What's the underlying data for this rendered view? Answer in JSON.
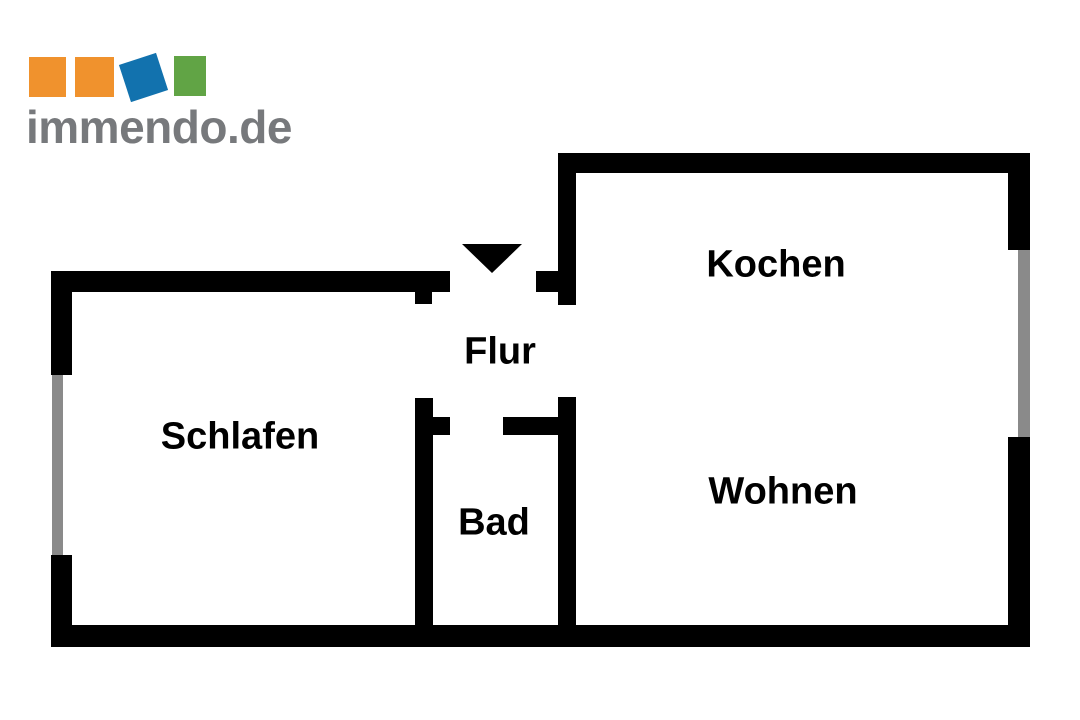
{
  "logo": {
    "text": "immendo.de",
    "squares": [
      "orange-square",
      "orange-square",
      "blue-tilted-square",
      "green-square"
    ]
  },
  "floorplan": {
    "rooms": [
      {
        "label": "Schlafen"
      },
      {
        "label": "Flur"
      },
      {
        "label": "Bad"
      },
      {
        "label": "Kochen"
      },
      {
        "label": "Wohnen"
      }
    ],
    "entrance_marker": "triangle-arrow-down"
  },
  "colors": {
    "wall": "#000000",
    "window": "#8a8a8a",
    "label": "#000000",
    "background": "#ffffff",
    "logo_text": "#77797c",
    "logo_orange": "#f0922d",
    "logo_blue": "#1272ae",
    "logo_green": "#61a445"
  }
}
